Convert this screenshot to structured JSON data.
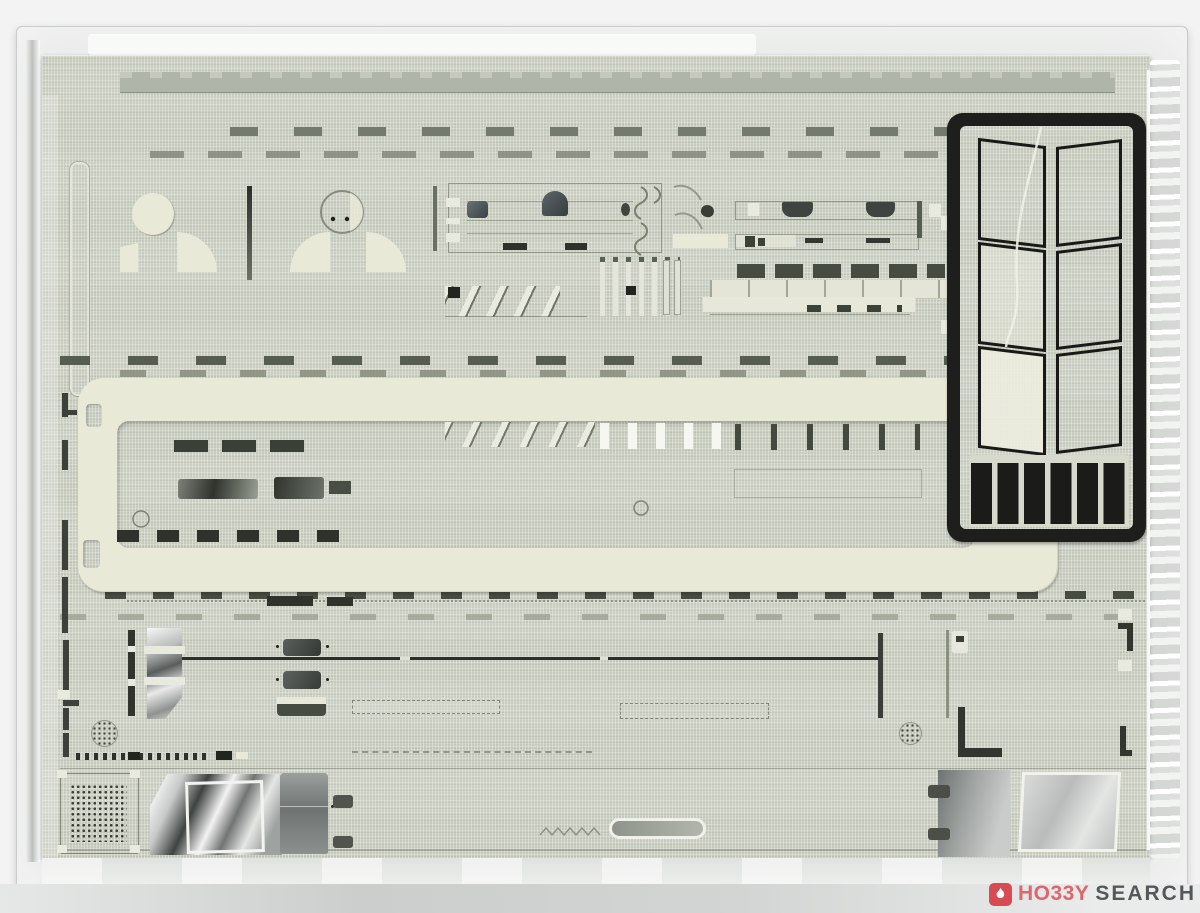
{
  "page": {
    "background_color": "#f2f3f2"
  },
  "photo": {
    "subject": "Laser-cut paper structure kit sheets sealed in a clear plastic bag",
    "bag": {
      "type": "clear plastic bag",
      "tint": "#e9ebe9",
      "right_edge": "crinkled with white highlights"
    },
    "sheet": {
      "color": "#c6cabd",
      "material": "linen-textured gray-green card",
      "cuts": "slots, dashes, windows, combs, diagonal hatches, perforated dot grilles"
    },
    "parts": {
      "cream_frame": {
        "color": "#e9e9d8",
        "shape": "long rounded-corner frame"
      },
      "black_fret": {
        "color": "#1e1e1c",
        "window_frames": 6,
        "solid_tabs": 6
      },
      "round_disc": {
        "color": "#e9e9d8"
      },
      "shiny_window_cutouts": 3,
      "pill_cutout": 1,
      "perforated_grille": "square dot grid plus two dotted circles"
    }
  },
  "watermark": {
    "icon": "flame-icon",
    "primary": "HO33Y",
    "secondary": "SEARCH",
    "accent_color": "#d84b52",
    "secondary_color": "#55585a"
  }
}
